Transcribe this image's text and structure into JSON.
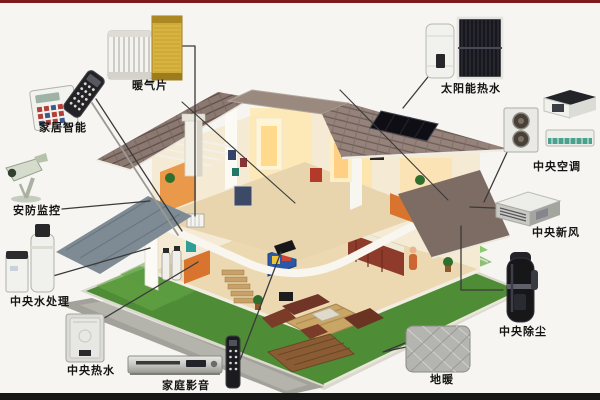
{
  "page": {
    "background": "#f6f5f1",
    "top_strip_color": "#7d1b1b",
    "bottom_strip_color": "#161616"
  },
  "colors": {
    "lawn_green": "#4f8c36",
    "roof_tile": "#93817a",
    "accent_orange": "#d9742f",
    "label_text": "#141414"
  },
  "devices": {
    "radiator": {
      "label": "暖气片"
    },
    "smart_home": {
      "label": "家居智能"
    },
    "security": {
      "label": "安防监控"
    },
    "water_treatment": {
      "label": "中央水处理"
    },
    "hot_water": {
      "label": "中央热水"
    },
    "home_theater": {
      "label": "家庭影音"
    },
    "floor_heating": {
      "label": "地暖"
    },
    "central_vacuum": {
      "label": "中央除尘"
    },
    "fresh_air": {
      "label": "中央新风"
    },
    "central_ac": {
      "label": "中央空调"
    },
    "solar_water": {
      "label": "太阳能热水"
    }
  }
}
